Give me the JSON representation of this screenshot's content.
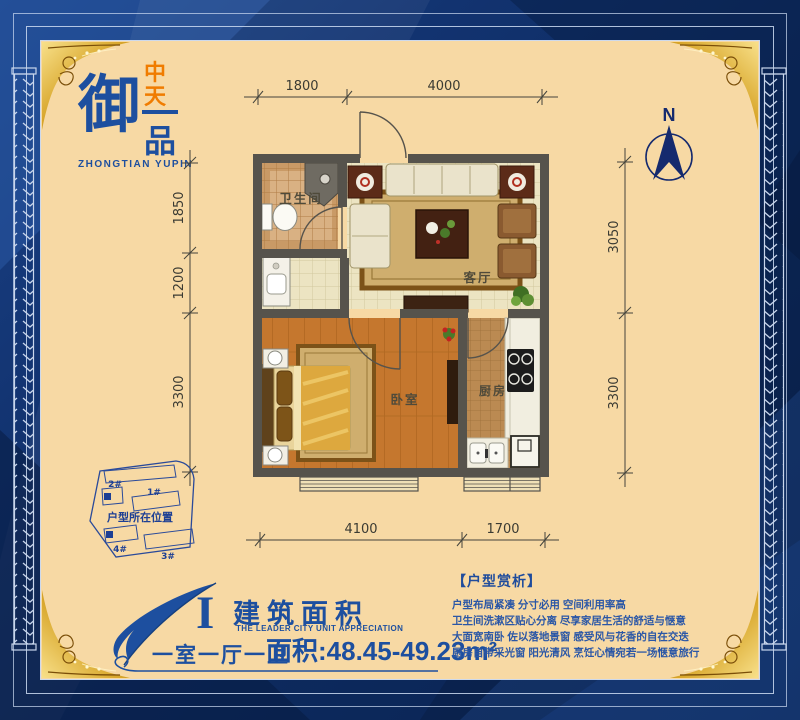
{
  "brand": {
    "logo_main": "御",
    "logo_sub": "品",
    "logo_cn_top": "中",
    "logo_cn_bottom": "天",
    "logo_en": "ZHONGTIAN YUPIN"
  },
  "compass": {
    "north": "N"
  },
  "floor_plan": {
    "rooms": {
      "bathroom": "卫生间",
      "living": "客厅",
      "bedroom": "卧室",
      "kitchen": "厨房"
    },
    "dimensions": {
      "top": [
        "1800",
        "4000"
      ],
      "left": [
        "1850",
        "1200",
        "3300"
      ],
      "right": [
        "3050",
        "3300"
      ],
      "bottom": [
        "4100",
        "1700"
      ]
    }
  },
  "site_plan": {
    "caption": "户型所在位置",
    "buildings": [
      "2#",
      "1#",
      "4#",
      "3#"
    ]
  },
  "title_block": {
    "numeral": "I",
    "title": "建筑面积",
    "subtitle": "THE LEADER CITY UNIT APPRECIATION",
    "layout": "一室一厅一卫",
    "area": "面积:48.45-49.23m²"
  },
  "analysis": {
    "header": "【户型赏析】",
    "lines": [
      "户型布局紧凑 分寸必用 空间利用率高",
      "卫生间洗漱区贴心分离 尽享家居生活的舒适与惬意",
      "大面宽南卧 佐以落地景窗 感受风与花香的自在交迭",
      "厨房自带采光窗 阳光清风 烹饪心情宛若一场惬意旅行"
    ]
  },
  "colors": {
    "panel": "#f7d9a4",
    "frame_blue": "#10316e",
    "gold": "#d8a62a",
    "logo_blue": "#1d4f9f",
    "logo_orange": "#f07c00",
    "text_blue": "#2b57a6",
    "wall_gray": "#56534c",
    "wood_floor": "#c5772e",
    "tile_cream": "#ece4c2",
    "tile_tan": "#c99a66"
  }
}
